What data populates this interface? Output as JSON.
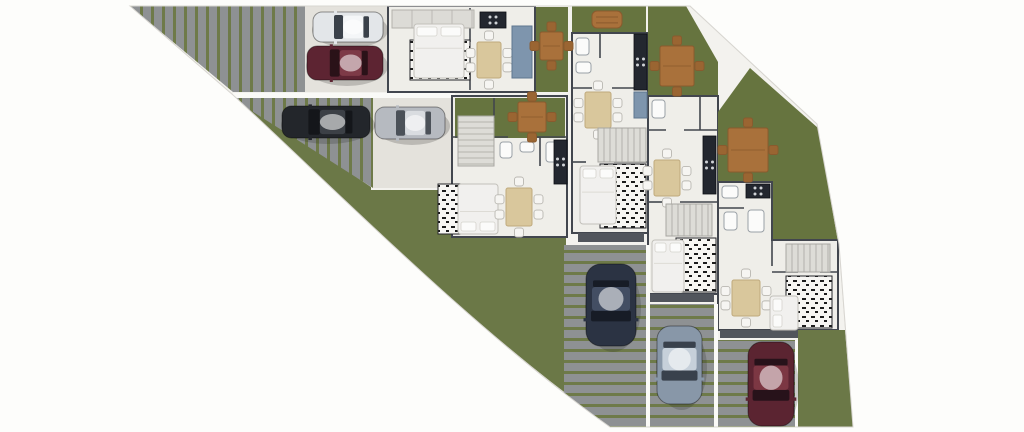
{
  "scene": {
    "width": 1024,
    "height": 432,
    "palette": {
      "page": "#fdfdfb",
      "base": "#f3f2ee",
      "baseEdge": "#d8d6d1",
      "lawn": "#6b7847",
      "lawnDark": "#66743f",
      "paver": "#8e9193",
      "gap": "#6e7a49",
      "pad": "#e4e2dc",
      "floor": "#efeee9",
      "wall": "#42464e",
      "balcony": "#51555c",
      "counter": "#23272f",
      "counterBlue": "#7e95ad",
      "tableWood": "#d9c79c",
      "tableEdge": "#bfa97c",
      "chair": "#f6f5f2",
      "chairEdge": "#b9b7b1",
      "owood": "#a9713b",
      "owoodDark": "#8a5a2d",
      "ochair": "#9a6532",
      "stair": "#dddcd7",
      "stairLine": "#a7a6a1",
      "rugBg": "#f7f6f3",
      "rugInk": "#1c1c1c",
      "bedLinen": "#f1f0ee",
      "bedEdge": "#c2c0ba",
      "pillow": "#fbfbfa",
      "fence": "#fafaf7"
    },
    "shapes": [
      {
        "k": "path",
        "n": "site-outline",
        "d": "M130,6 L690,6 L817,124 L839,244 L853,427 L610,427 C475,332 329,183 233,95 Z",
        "f": "$base",
        "s": "$baseEdge",
        "sw": 1
      },
      {
        "k": "path",
        "n": "main-lawn",
        "d": "M233,95 L307,144 L371,187 L371,190 L455,190 L455,237 L566,237 L566,427 L612,427 C475,332 329,183 233,95 Z",
        "f": "$lawn"
      },
      {
        "k": "poly",
        "n": "driveway-1",
        "p": [
          [
            130,
            6
          ],
          [
            305,
            6
          ],
          [
            305,
            92
          ],
          [
            233,
            92
          ]
        ],
        "f": "@pv"
      },
      {
        "k": "rect",
        "n": "parking-pad-1",
        "x": 305,
        "y": 6,
        "w": 84,
        "h": 86,
        "f": "$pad"
      },
      {
        "k": "rect",
        "n": "fence-1",
        "x": 233,
        "y": 93,
        "w": 222,
        "h": 5,
        "f": "$fence"
      },
      {
        "k": "poly",
        "n": "driveway-2",
        "p": [
          [
            231,
            98
          ],
          [
            373,
            98
          ],
          [
            373,
            188
          ],
          [
            307,
            146
          ]
        ],
        "f": "@pv"
      },
      {
        "k": "rect",
        "n": "parking-pad-2",
        "x": 373,
        "y": 98,
        "w": 80,
        "h": 90,
        "f": "$pad"
      },
      {
        "k": "rect",
        "n": "unit-2-slab",
        "x": 452,
        "y": 96,
        "w": 115,
        "h": 141,
        "f": "$floor",
        "s": "$wall",
        "sw": 2
      },
      {
        "k": "rect",
        "n": "yard-2",
        "x": 455,
        "y": 98,
        "w": 110,
        "h": 40,
        "f": "$lawnDark"
      },
      {
        "k": "rect",
        "n": "unit-1-slab",
        "x": 388,
        "y": 6,
        "w": 147,
        "h": 86,
        "f": "$floor",
        "s": "$wall",
        "sw": 2
      },
      {
        "k": "rect",
        "n": "yard-1",
        "x": 536,
        "y": 7,
        "w": 32,
        "h": 85,
        "f": "$lawnDark"
      },
      {
        "k": "rect",
        "n": "yard-3",
        "x": 572,
        "y": 6,
        "w": 74,
        "h": 27,
        "f": "$lawnDark"
      },
      {
        "k": "rect",
        "n": "unit-3-slab",
        "x": 572,
        "y": 33,
        "w": 76,
        "h": 200,
        "f": "$floor",
        "s": "$wall",
        "sw": 2
      },
      {
        "k": "rect",
        "n": "balcony-3",
        "x": 578,
        "y": 233,
        "w": 66,
        "h": 9,
        "f": "$balcony"
      },
      {
        "k": "rect",
        "n": "driveway-3",
        "x": 564,
        "y": 245,
        "w": 84,
        "h": 182,
        "f": "@ph"
      },
      {
        "k": "poly",
        "n": "yard-4",
        "p": [
          [
            648,
            6
          ],
          [
            686,
            6
          ],
          [
            718,
            62
          ],
          [
            718,
            96
          ],
          [
            648,
            96
          ]
        ],
        "f": "$lawnDark"
      },
      {
        "k": "rect",
        "n": "unit-4-slab",
        "x": 648,
        "y": 96,
        "w": 70,
        "h": 198,
        "f": "$floor",
        "s": "$wall",
        "sw": 2
      },
      {
        "k": "rect",
        "n": "balcony-4",
        "x": 650,
        "y": 294,
        "w": 64,
        "h": 8,
        "f": "$balcony"
      },
      {
        "k": "rect",
        "n": "driveway-4",
        "x": 650,
        "y": 304,
        "w": 66,
        "h": 123,
        "f": "@ph"
      },
      {
        "k": "poly",
        "n": "yard-5",
        "p": [
          [
            718,
            112
          ],
          [
            750,
            68
          ],
          [
            818,
            128
          ],
          [
            838,
            242
          ],
          [
            718,
            242
          ]
        ],
        "f": "$lawnDark"
      },
      {
        "k": "path",
        "n": "unit-5-slab",
        "d": "M718,182 L772,182 L772,240 L838,240 L838,330 L718,330 Z",
        "f": "$floor",
        "s": "$wall",
        "sw": 2
      },
      {
        "k": "rect",
        "n": "balcony-5",
        "x": 720,
        "y": 330,
        "w": 78,
        "h": 8,
        "f": "$balcony"
      },
      {
        "k": "rect",
        "n": "driveway-5",
        "x": 718,
        "y": 340,
        "w": 80,
        "h": 87,
        "f": "@ph"
      },
      {
        "k": "poly",
        "n": "yard-6",
        "p": [
          [
            798,
            330
          ],
          [
            845,
            330
          ],
          [
            853,
            427
          ],
          [
            798,
            427
          ]
        ],
        "f": "$lawn"
      },
      {
        "k": "rect",
        "n": "fence-2",
        "x": 646,
        "y": 245,
        "w": 4,
        "h": 182,
        "f": "$fence"
      },
      {
        "k": "rect",
        "n": "fence-3",
        "x": 714,
        "y": 304,
        "w": 4,
        "h": 123,
        "f": "$fence"
      },
      {
        "k": "rect",
        "n": "fence-4",
        "x": 795,
        "y": 340,
        "w": 3,
        "h": 87,
        "f": "$fence"
      },
      {
        "k": "line",
        "n": "interior-wall",
        "x1": 470,
        "y1": 8,
        "x2": 470,
        "y2": 42
      },
      {
        "k": "line",
        "n": "interior-wall",
        "x1": 470,
        "y1": 62,
        "x2": 470,
        "y2": 90
      },
      {
        "k": "line",
        "n": "interior-wall",
        "x1": 452,
        "y1": 137,
        "x2": 508,
        "y2": 137
      },
      {
        "k": "line",
        "n": "interior-wall",
        "x1": 528,
        "y1": 137,
        "x2": 567,
        "y2": 137
      },
      {
        "k": "line",
        "n": "interior-wall",
        "x1": 540,
        "y1": 137,
        "x2": 540,
        "y2": 166
      },
      {
        "k": "line",
        "n": "interior-wall",
        "x1": 494,
        "y1": 98,
        "x2": 494,
        "y2": 118
      },
      {
        "k": "line",
        "n": "interior-wall",
        "x1": 600,
        "y1": 33,
        "x2": 600,
        "y2": 58
      },
      {
        "k": "line",
        "n": "interior-wall",
        "x1": 572,
        "y1": 88,
        "x2": 592,
        "y2": 88
      },
      {
        "k": "line",
        "n": "interior-wall",
        "x1": 612,
        "y1": 88,
        "x2": 648,
        "y2": 88
      },
      {
        "k": "line",
        "n": "interior-wall",
        "x1": 572,
        "y1": 162,
        "x2": 586,
        "y2": 162
      },
      {
        "k": "line",
        "n": "interior-wall",
        "x1": 614,
        "y1": 162,
        "x2": 648,
        "y2": 162
      },
      {
        "k": "line",
        "n": "interior-wall",
        "x1": 648,
        "y1": 130,
        "x2": 666,
        "y2": 130
      },
      {
        "k": "line",
        "n": "interior-wall",
        "x1": 684,
        "y1": 130,
        "x2": 718,
        "y2": 130
      },
      {
        "k": "line",
        "n": "interior-wall",
        "x1": 700,
        "y1": 96,
        "x2": 700,
        "y2": 130
      },
      {
        "k": "line",
        "n": "interior-wall",
        "x1": 648,
        "y1": 202,
        "x2": 662,
        "y2": 202
      },
      {
        "k": "line",
        "n": "interior-wall",
        "x1": 680,
        "y1": 202,
        "x2": 718,
        "y2": 202
      },
      {
        "k": "line",
        "n": "interior-wall",
        "x1": 718,
        "y1": 208,
        "x2": 744,
        "y2": 208
      },
      {
        "k": "line",
        "n": "interior-wall",
        "x1": 772,
        "y1": 240,
        "x2": 772,
        "y2": 266
      },
      {
        "k": "line",
        "n": "interior-wall",
        "x1": 772,
        "y1": 272,
        "x2": 798,
        "y2": 272
      },
      {
        "k": "line",
        "n": "interior-wall",
        "x1": 820,
        "y1": 272,
        "x2": 838,
        "y2": 272
      },
      {
        "k": "ward",
        "n": "wardrobe-1",
        "x": 392,
        "y": 10,
        "w": 82,
        "h": 18
      },
      {
        "k": "rug",
        "n": "rug-1",
        "x": 410,
        "y": 40,
        "w": 60,
        "h": 40
      },
      {
        "k": "bed",
        "n": "bed-1",
        "x": 414,
        "y": 24,
        "w": 50,
        "h": 54,
        "dir": "up"
      },
      {
        "k": "dtable",
        "n": "dining-table-1",
        "x": 477,
        "y": 42,
        "w": 24,
        "h": 36
      },
      {
        "k": "counter",
        "n": "kitchen-counter-1",
        "x": 480,
        "y": 12,
        "w": 26,
        "h": 16,
        "stove": true
      },
      {
        "k": "rect",
        "n": "island-counter-1",
        "x": 512,
        "y": 26,
        "w": 20,
        "h": 52,
        "f": "$counterBlue",
        "s": "#5f7790",
        "sw": 1
      },
      {
        "k": "otable",
        "n": "patio-table-1",
        "x": 540,
        "y": 32,
        "w": 23,
        "h": 28
      },
      {
        "k": "stairs",
        "n": "stairs-2",
        "x": 458,
        "y": 116,
        "w": 36,
        "h": 50,
        "dir": "v"
      },
      {
        "k": "fix",
        "n": "toilet-2",
        "x": 500,
        "y": 142,
        "w": 12,
        "h": 16
      },
      {
        "k": "fix",
        "n": "sink-2",
        "x": 520,
        "y": 142,
        "w": 14,
        "h": 10
      },
      {
        "k": "fix",
        "n": "shower-2",
        "x": 546,
        "y": 142,
        "w": 16,
        "h": 20
      },
      {
        "k": "counter",
        "n": "kitchen-counter-2",
        "x": 554,
        "y": 140,
        "w": 13,
        "h": 44,
        "stove": true
      },
      {
        "k": "rug",
        "n": "rug-2",
        "x": 438,
        "y": 184,
        "w": 46,
        "h": 50
      },
      {
        "k": "bed",
        "n": "bed-2",
        "x": 458,
        "y": 184,
        "w": 40,
        "h": 50,
        "dir": "down"
      },
      {
        "k": "dtable",
        "n": "dining-table-2",
        "x": 506,
        "y": 188,
        "w": 26,
        "h": 38
      },
      {
        "k": "otable",
        "n": "patio-table-2",
        "x": 518,
        "y": 102,
        "w": 28,
        "h": 30
      },
      {
        "k": "bench",
        "n": "garden-bench-3",
        "x": 592,
        "y": 11,
        "w": 30,
        "h": 17
      },
      {
        "k": "fix",
        "n": "toilet-3",
        "x": 576,
        "y": 38,
        "w": 13,
        "h": 17
      },
      {
        "k": "fix",
        "n": "sink-3",
        "x": 576,
        "y": 62,
        "w": 15,
        "h": 11
      },
      {
        "k": "counter",
        "n": "kitchen-counter-3",
        "x": 634,
        "y": 34,
        "w": 13,
        "h": 56,
        "stove": true
      },
      {
        "k": "rect",
        "n": "island-counter-3",
        "x": 634,
        "y": 92,
        "w": 13,
        "h": 26,
        "f": "$counterBlue",
        "s": "#5f7790",
        "sw": 1
      },
      {
        "k": "dtable",
        "n": "dining-table-3",
        "x": 585,
        "y": 92,
        "w": 26,
        "h": 36
      },
      {
        "k": "stairs",
        "n": "stairs-3",
        "x": 598,
        "y": 128,
        "w": 48,
        "h": 34,
        "dir": "h"
      },
      {
        "k": "rug",
        "n": "rug-3",
        "x": 600,
        "y": 164,
        "w": 46,
        "h": 64
      },
      {
        "k": "bed",
        "n": "bed-3",
        "x": 580,
        "y": 166,
        "w": 36,
        "h": 58,
        "dir": "up"
      },
      {
        "k": "otable",
        "n": "patio-table-4",
        "x": 660,
        "y": 46,
        "w": 34,
        "h": 40
      },
      {
        "k": "fix",
        "n": "toilet-4",
        "x": 652,
        "y": 100,
        "w": 13,
        "h": 18
      },
      {
        "k": "counter",
        "n": "kitchen-counter-4",
        "x": 703,
        "y": 136,
        "w": 13,
        "h": 58,
        "stove": true
      },
      {
        "k": "dtable",
        "n": "dining-table-4",
        "x": 654,
        "y": 160,
        "w": 26,
        "h": 36
      },
      {
        "k": "stairs",
        "n": "stairs-4",
        "x": 666,
        "y": 204,
        "w": 46,
        "h": 32,
        "dir": "h"
      },
      {
        "k": "rug",
        "n": "rug-4",
        "x": 676,
        "y": 238,
        "w": 40,
        "h": 54
      },
      {
        "k": "bed",
        "n": "bed-4",
        "x": 652,
        "y": 240,
        "w": 32,
        "h": 52,
        "dir": "up"
      },
      {
        "k": "otable",
        "n": "patio-table-5",
        "x": 728,
        "y": 128,
        "w": 40,
        "h": 44
      },
      {
        "k": "counter",
        "n": "kitchen-counter-5",
        "x": 746,
        "y": 184,
        "w": 24,
        "h": 14,
        "stove": true
      },
      {
        "k": "fix",
        "n": "sink-5",
        "x": 722,
        "y": 186,
        "w": 16,
        "h": 12
      },
      {
        "k": "fix",
        "n": "toilet-5",
        "x": 724,
        "y": 212,
        "w": 13,
        "h": 18
      },
      {
        "k": "fix",
        "n": "bath-5",
        "x": 748,
        "y": 210,
        "w": 16,
        "h": 22
      },
      {
        "k": "stairs",
        "n": "stairs-5",
        "x": 786,
        "y": 244,
        "w": 44,
        "h": 28,
        "dir": "h"
      },
      {
        "k": "dtable",
        "n": "dining-table-5",
        "x": 732,
        "y": 280,
        "w": 28,
        "h": 36
      },
      {
        "k": "rug",
        "n": "rug-5",
        "x": 786,
        "y": 276,
        "w": 46,
        "h": 52
      },
      {
        "k": "bed",
        "n": "bed-5",
        "x": 770,
        "y": 296,
        "w": 28,
        "h": 34,
        "dir": "left"
      },
      {
        "k": "car",
        "n": "car-white",
        "x": 313,
        "y": 12,
        "w": 70,
        "h": 30,
        "dir": "left",
        "body": "#e3e6e9",
        "roof": "#f4f6f8",
        "glass": "#3a414a"
      },
      {
        "k": "car",
        "n": "car-maroon-top",
        "x": 307,
        "y": 46,
        "w": 76,
        "h": 34,
        "dir": "left",
        "body": "#5d2432",
        "roof": "#7d3a47",
        "glass": "#2a1218"
      },
      {
        "k": "car",
        "n": "car-black",
        "x": 282,
        "y": 106,
        "w": 88,
        "h": 32,
        "dir": "left",
        "body": "#23262b",
        "roof": "#3c4046",
        "glass": "#14161a"
      },
      {
        "k": "car",
        "n": "car-silver",
        "x": 375,
        "y": 107,
        "w": 70,
        "h": 32,
        "dir": "left",
        "body": "#b6bac0",
        "roof": "#d9dce0",
        "glass": "#4b5158"
      },
      {
        "k": "car",
        "n": "car-navy",
        "x": 586,
        "y": 264,
        "w": 50,
        "h": 82,
        "dir": "down",
        "body": "#2b3343",
        "roof": "#434e63",
        "glass": "#171c26"
      },
      {
        "k": "car",
        "n": "car-steel-blue",
        "x": 657,
        "y": 326,
        "w": 45,
        "h": 78,
        "dir": "down",
        "body": "#8897a8",
        "roof": "#c6d0da",
        "glass": "#39414c"
      },
      {
        "k": "car",
        "n": "car-maroon-bottom",
        "x": 748,
        "y": 342,
        "w": 46,
        "h": 84,
        "dir": "down",
        "body": "#5b2431",
        "roof": "#7c3743",
        "glass": "#27121a"
      }
    ]
  }
}
